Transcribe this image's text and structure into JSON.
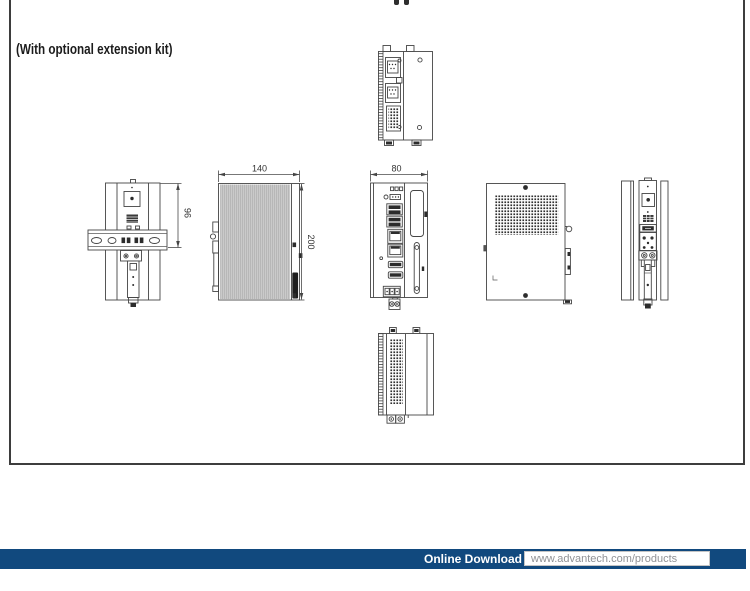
{
  "caption": "(With optional extension kit)",
  "dimensions": {
    "front_width": "140",
    "front_height": "200",
    "side_width": "80",
    "rail_height": "96"
  },
  "footer": {
    "label": "Online Download",
    "url": "www.advantech.com/products",
    "bar_color": "#11497e",
    "url_color": "#909296"
  },
  "colors": {
    "drawing_line": "#454545",
    "frame_border": "#3d3d3d"
  }
}
